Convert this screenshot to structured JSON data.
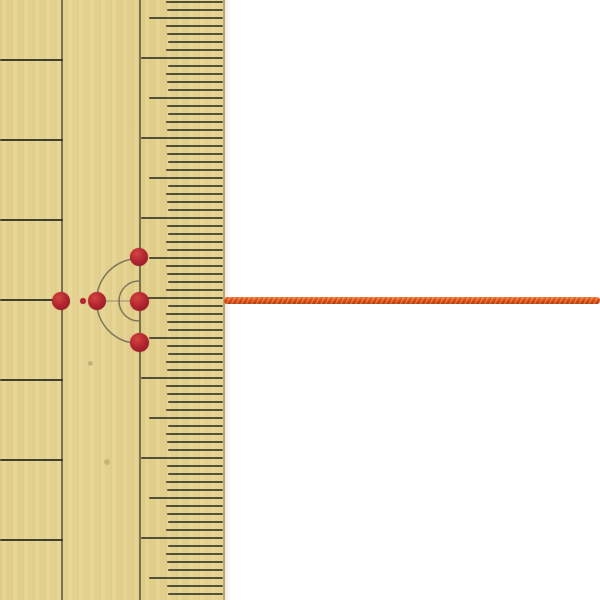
{
  "scene": {
    "description": "Product photo: traditional bamboo ruler with red marking dots and guide arcs, an orange braided cord extending right at the center mark",
    "background_color": "#ffffff",
    "width": 600,
    "height": 600
  },
  "ruler": {
    "x": 0,
    "width": 225,
    "height": 600,
    "edge_color": "#b7a665",
    "edge_x": 223,
    "line_color_strong": "rgba(52,50,38,0.92)",
    "tick_color": "rgba(62,60,46,0.88)",
    "vline_color": "rgba(80,76,58,0.72)",
    "main_vline_x": 62,
    "scale_vline_x": 140,
    "left_lines_y": [
      60,
      140,
      220,
      300,
      380,
      460,
      540
    ],
    "left_line_right_x": 63,
    "left_line_thickness": 2.6,
    "ticks": {
      "start_y": 2,
      "spacing": 8,
      "count": 75,
      "right_x": 223,
      "mm_left_x": 167,
      "five_left_x": 149,
      "cm_left_x": 141,
      "cm_phase_y": 58,
      "five_phase_y": 18,
      "mm_thickness": 1.9,
      "cm_thickness": 2.4
    },
    "blemishes": [
      {
        "x": 107,
        "y": 462,
        "r": 3,
        "color": "rgba(120,100,50,0.25)"
      },
      {
        "x": 90,
        "y": 363,
        "r": 2.5,
        "color": "rgba(110,90,45,0.28)"
      }
    ]
  },
  "marks": {
    "dot_color_highlight": "#d2463e",
    "dot_color_mid": "#b22531",
    "dot_color_dark": "#871820",
    "arc_color": "#6b6754",
    "arc_thickness": 1.5,
    "dots": [
      {
        "cx": 61,
        "cy": 301,
        "r": 9
      },
      {
        "cx": 83,
        "cy": 301,
        "r": 3
      },
      {
        "cx": 97,
        "cy": 301,
        "r": 9
      },
      {
        "cx": 139,
        "cy": 301,
        "r": 9.5
      },
      {
        "cx": 139,
        "cy": 257,
        "r": 9
      },
      {
        "cx": 139,
        "cy": 342,
        "r": 9.5
      }
    ],
    "arcs": [
      {
        "cx": 139,
        "cy": 301,
        "r": 42.5
      },
      {
        "cx": 139,
        "cy": 301,
        "r": 20
      }
    ],
    "center_line": {
      "x1": 96,
      "x2": 141,
      "y": 301,
      "color": "rgba(95,90,72,0.55)"
    }
  },
  "cord": {
    "x1": 224,
    "x2": 600,
    "y_center": 300.5,
    "thickness": 7,
    "color": "#e8581a",
    "color_dark": "#c2440c",
    "color_light": "#f4803f"
  }
}
